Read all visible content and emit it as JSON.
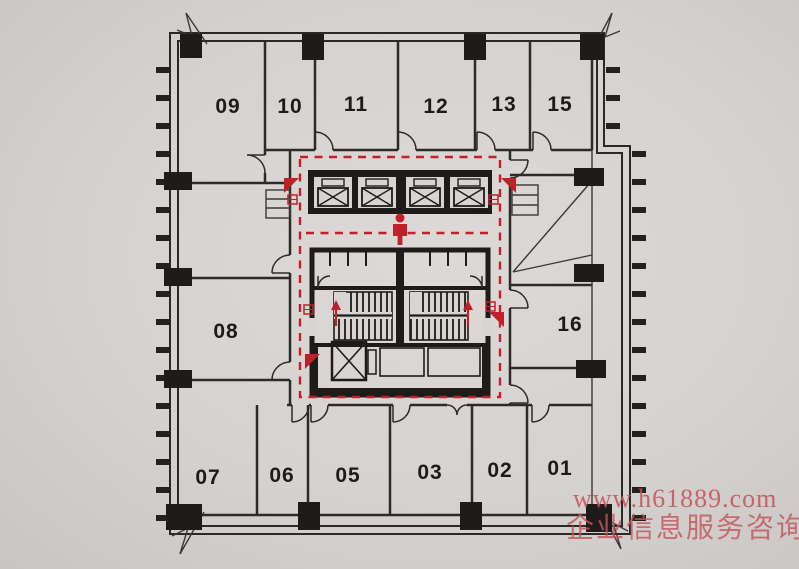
{
  "document": {
    "type": "building-floor-plan-photo"
  },
  "rooms": {
    "top": [
      "09",
      "10",
      "11",
      "12",
      "13",
      "15"
    ],
    "left": [
      "08"
    ],
    "right": [
      "16"
    ],
    "bottom": [
      "07",
      "06",
      "05",
      "03",
      "02",
      "01"
    ]
  },
  "core": {
    "elevator_count": 4,
    "features": [
      "elevator-bank",
      "restrooms",
      "twin-stairs",
      "service-elevator",
      "evacuation-route",
      "person-marker"
    ]
  },
  "watermark": {
    "line1": "www.h61889.com",
    "line2": "企业信息服务咨询",
    "color": "#c4565e"
  },
  "colors": {
    "paper": "#d7d4d1",
    "wall": "#1e1c1a",
    "plan_red": "#c0202a"
  }
}
